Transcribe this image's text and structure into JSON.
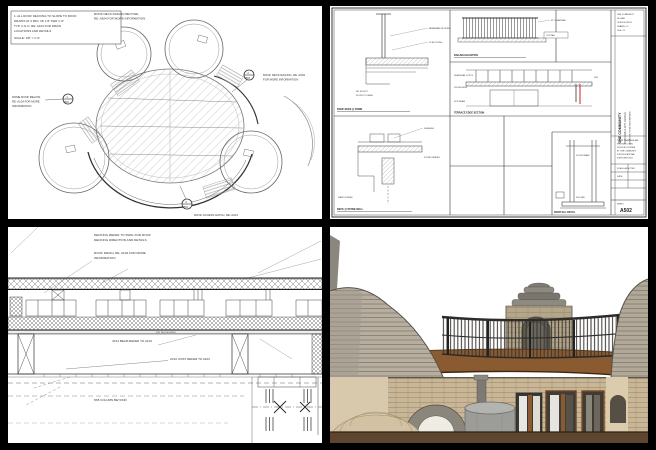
{
  "page": {
    "description": "Four-view architectural sheet montage: dome roof plan, construction detail sheet, roof deck building section, and 3D stone dome building rendering"
  },
  "colors": {
    "paper": "#ffffff",
    "frame": "#000000",
    "ink": "#333333",
    "accent_red": "#cc2222",
    "render_fascia_brown": "#8a5a30",
    "render_ground_brown": "#5d4530",
    "render_stone_gray": "#b7ae9f",
    "render_wall_tan": "#d9c9ac",
    "render_block_tan": "#c9b697",
    "render_railing_dark": "#2e2c29",
    "render_tank_gray": "#9c9c99"
  },
  "tl": {
    "note_box": [
      "1. ALL ROOF DECKING TO SLOPE TO ROOF",
      "DRAINS AT A MIN. OF 1/4\" PER 1'-0\"",
      "TYP. U.N.O. RE: A104 FOR DRAIN",
      "LOCATIONS AND DETAILS",
      "SCALE: 1/8\" = 1'-0\""
    ],
    "top_note": [
      "ROOF DECK RAILING BEYOND,",
      "RE: A504 FOR MORE INFORMATION"
    ],
    "left_note": [
      "DOME ROOF BELOW,",
      "RE: A104 FOR MORE",
      "INFORMATION"
    ],
    "right_note": [
      "ROOF DECK RAILING, RE: A504",
      "FOR MORE INFORMATION"
    ],
    "bottom_note": "ROOF ACCESS HATCH, RE: A104",
    "callouts": [
      {
        "num": "1",
        "sheet": "A502"
      },
      {
        "num": "2",
        "sheet": "A502"
      },
      {
        "num": "3",
        "sheet": "A502"
      }
    ]
  },
  "tr": {
    "titleblock": {
      "firm_lines": [
        "ONE COMMUNITY",
        "GLOBAL",
        "OPEN SOURCE",
        "DRAWN: OC",
        "CHK: OC"
      ],
      "project_name": "ONE COMMUNITY",
      "project_sub": "DUPLICABLE CITY CENTER",
      "project_loc": "LOCATION TO BE DETERMINED",
      "notes_lines": [
        "THESE DRAWINGS ARE",
        "PROVIDED OPEN",
        "SOURCE FOR FREE",
        "BY ONE COMMUNITY",
        "FOR EDUCATIONAL",
        "PURPOSES ONLY."
      ],
      "scale_label": "SCALE: AS NOTED",
      "date_label": "DATE:",
      "sheet_label": "SHEET",
      "sheet_number": "A502"
    },
    "panels": [
      {
        "num": "1",
        "caption": "ROOF EDGE @ DOME",
        "ann": [
          "MEMBRANE ROOFING",
          "2X BLOCKING",
          "RE: STRUCT",
          "SLOPE TO DRAIN"
        ]
      },
      {
        "num": "2",
        "caption": "RAILING ELEVATION",
        "ann": [
          "42\" GUARDRAIL",
          "TOP RAIL",
          "DECKING"
        ]
      },
      {
        "num": "3",
        "caption": "TERRACE EDGE SECTION",
        "ann": [
          "GUARDRAIL POSTS",
          "2X6 DECKING",
          "4X12 BEAM",
          "SIM"
        ]
      },
      {
        "num": "4",
        "caption": "DECK @ STONE WALL",
        "ann": [
          "FLASHING",
          "STONE VENEER",
          "WEEP SCREED"
        ]
      },
      {
        "num": "5",
        "caption": "DOOR SILL DETAIL",
        "ann": [
          "DOOR FRAME",
          "SILL PAN"
        ]
      }
    ]
  },
  "bl": {
    "note1": [
      "DECKING REFER TO SW01 FOR ROOF",
      "DECKING DIRECTION AND DETAILS"
    ],
    "note2": [
      "ROOF DRAIN, RE: A104 FOR MORE",
      "INFORMATION"
    ],
    "deck_label": "2X6 T&G DECKING",
    "beam_label": "4X12 BEAM REFER TO A103",
    "joist_label": "2X10 JOIST REFER TO A103",
    "column_label": "8X8 COLUMN BEYOND"
  },
  "br": {
    "description": "3D rendering of stone dome building with roof terrace railing, curved wood fascia, central cupola, arched stone wall and doors"
  }
}
